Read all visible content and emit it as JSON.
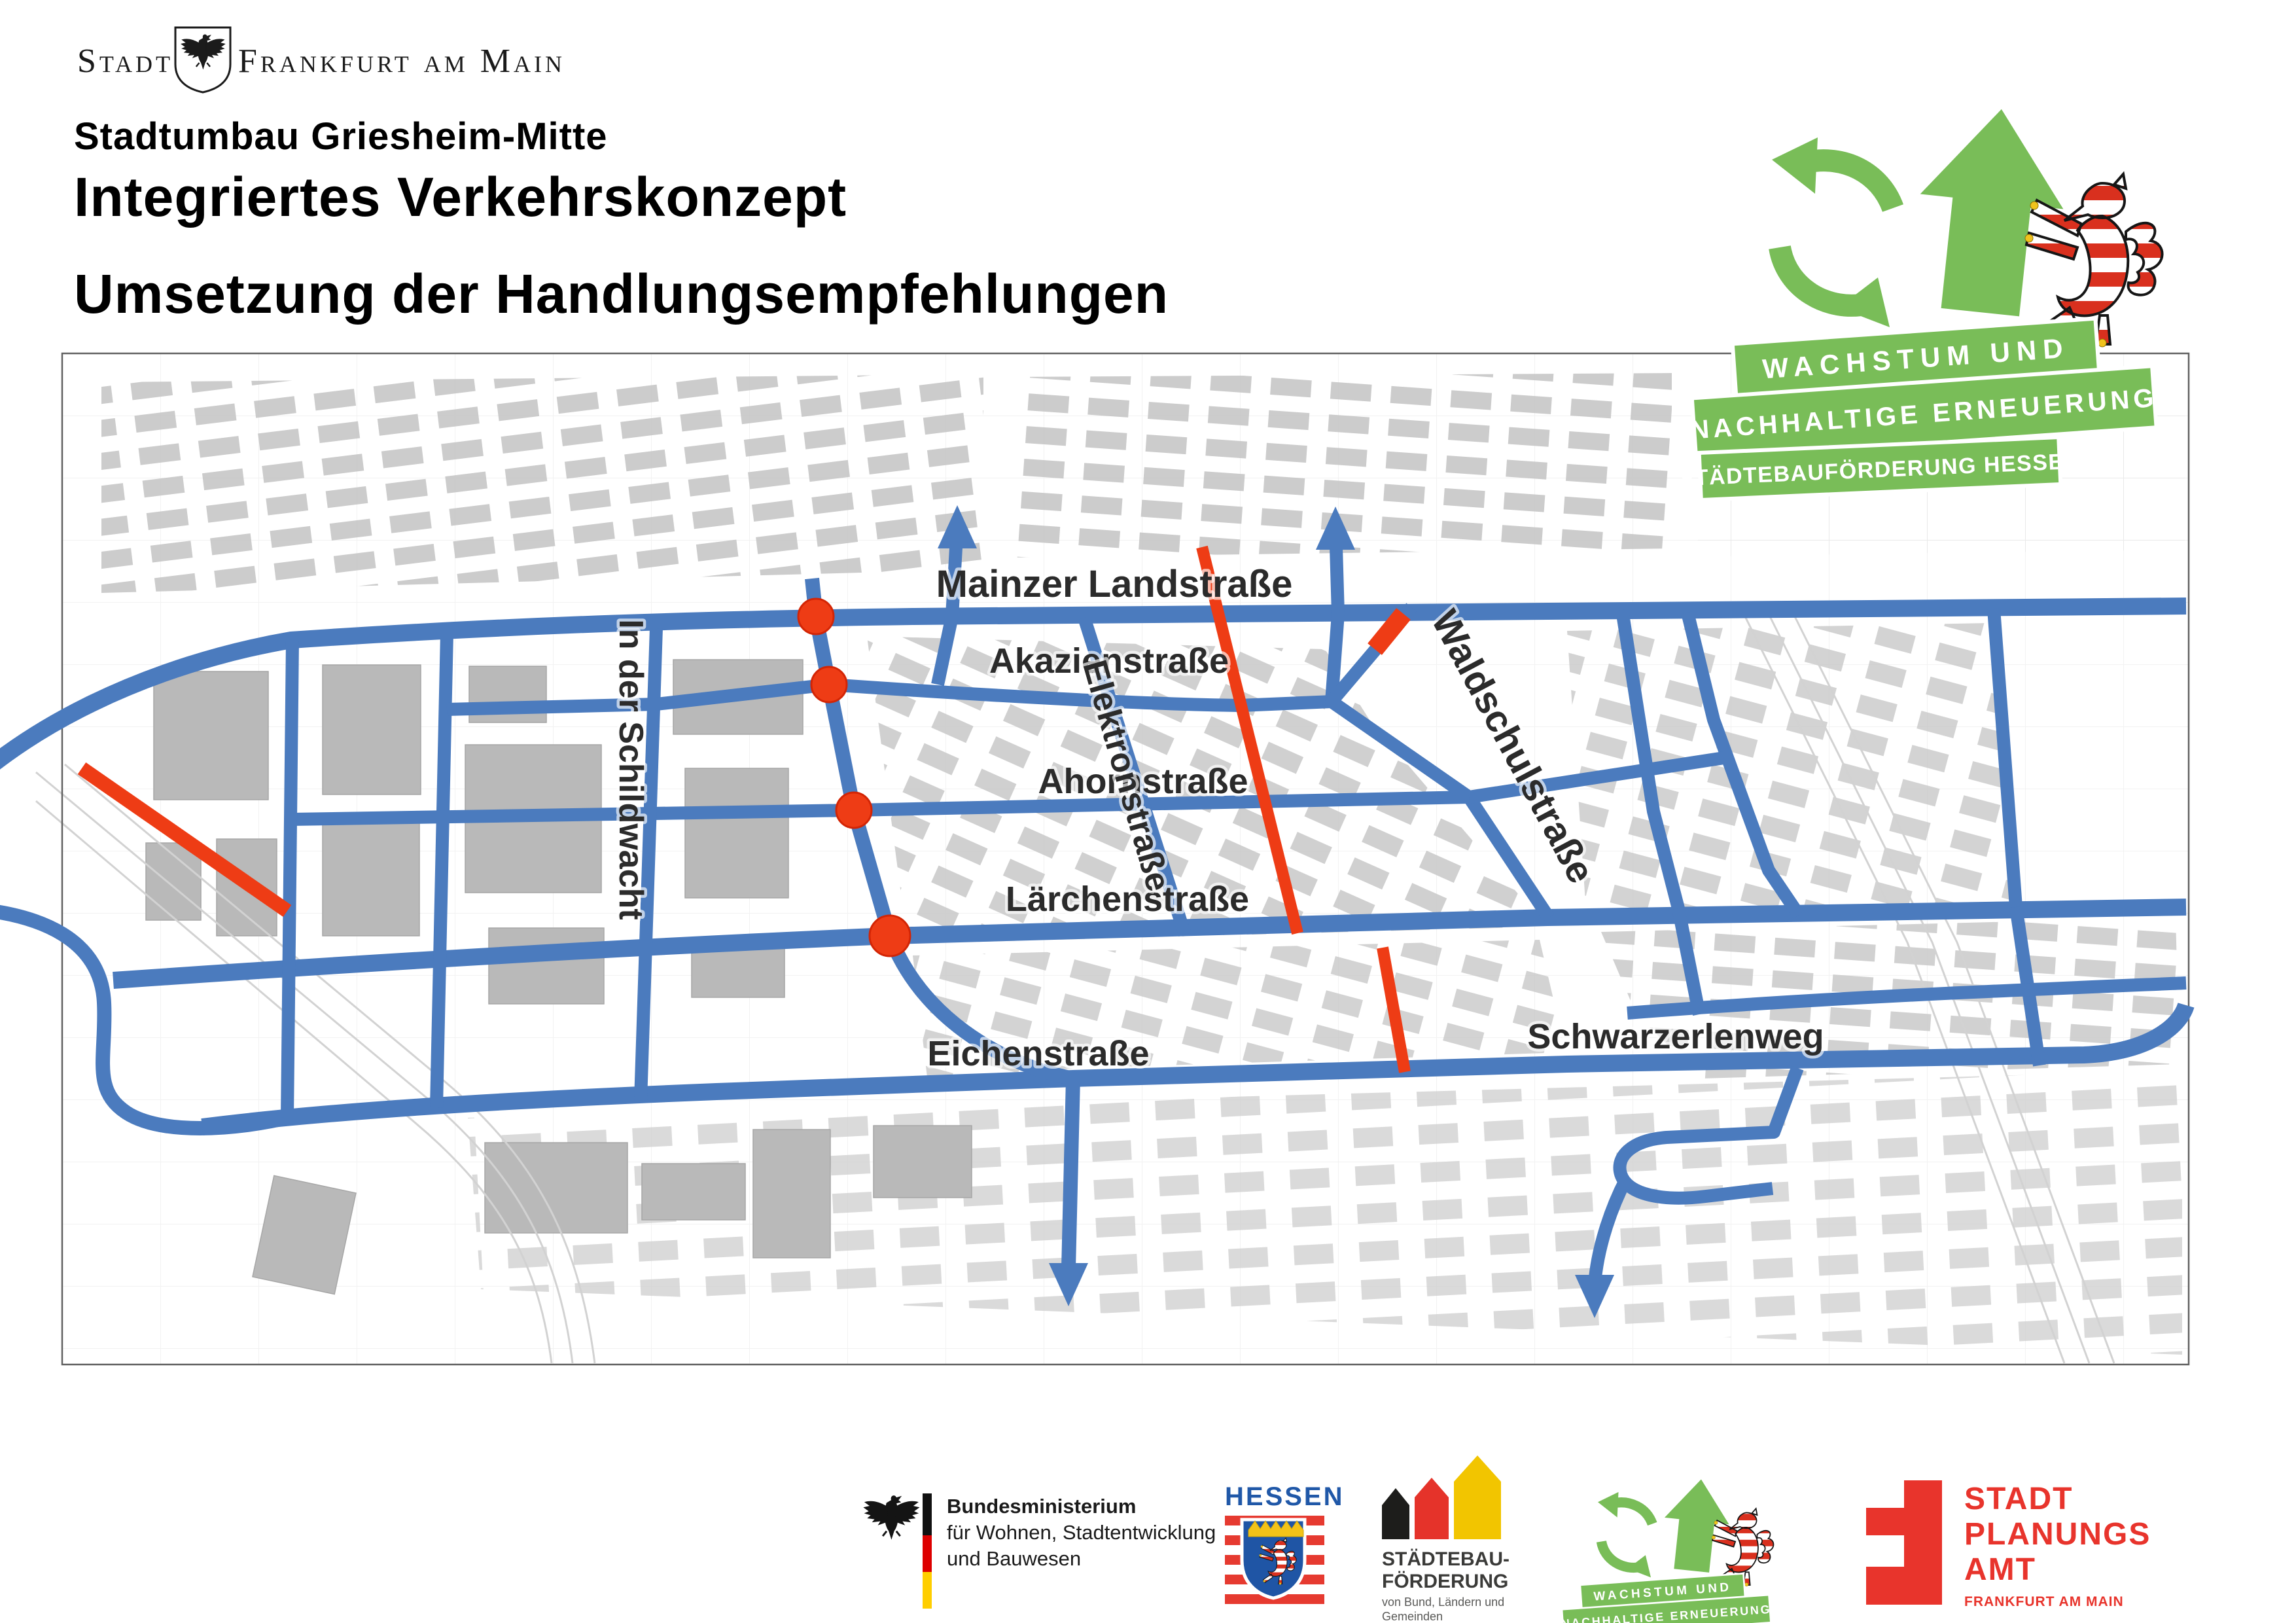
{
  "header": {
    "city_logo": {
      "prefix": "Stadt",
      "name": "Frankfurt am Main"
    },
    "subtitle": "Stadtumbau Griesheim-Mitte",
    "title": "Integriertes Verkehrskonzept",
    "subject": "Umsetzung der Handlungsempfehlungen"
  },
  "program_logo": {
    "line1": "WACHSTUM UND",
    "line2": "NACHHALTIGE ERNEUERUNG",
    "line3": "STÄDTEBAUFÖRDERUNG HESSEN"
  },
  "map": {
    "street_labels": [
      {
        "id": "mainzer-landstrasse",
        "text": "Mainzer Landstraße"
      },
      {
        "id": "akazienstrasse",
        "text": "Akazienstraße"
      },
      {
        "id": "ahornstrasse",
        "text": "Ahornstraße"
      },
      {
        "id": "laerchenstrasse",
        "text": "Lärchenstraße"
      },
      {
        "id": "eichenstrasse",
        "text": "Eichenstraße"
      },
      {
        "id": "schwarzerlenweg",
        "text": "Schwarzerlenweg"
      },
      {
        "id": "in-der-schildwacht",
        "text": "In der Schildwacht"
      },
      {
        "id": "elektronstrasse",
        "text": "Elektronstraße"
      },
      {
        "id": "waldschulstrasse",
        "text": "Waldschulstraße"
      }
    ],
    "colors": {
      "street_network": "#4b7bbe",
      "highlight": "#ee3c15",
      "building": "#bcbcbc",
      "label": "#2b2b2b"
    }
  },
  "footer": {
    "bmwsb": {
      "line1": "Bundesministerium",
      "line2": "für Wohnen, Stadtentwicklung",
      "line3": "und Bauwesen"
    },
    "hessen": {
      "name": "HESSEN"
    },
    "staedtebaufoerderung": {
      "line1": "STÄDTEBAU-",
      "line2": "FÖRDERUNG",
      "sub1": "von Bund, Ländern und",
      "sub2": "Gemeinden"
    },
    "stadtplanungsamt": {
      "line1": "STADT",
      "line2": "PLANUNGS",
      "line3": "AMT",
      "sub": "FRANKFURT AM MAIN"
    }
  },
  "colors": {
    "program_green": "#79bd58",
    "spa_red": "#e8342c",
    "hessen_blue": "#2058a8",
    "flag_black": "#111111",
    "flag_red": "#dd0000",
    "flag_gold": "#ffce00"
  }
}
